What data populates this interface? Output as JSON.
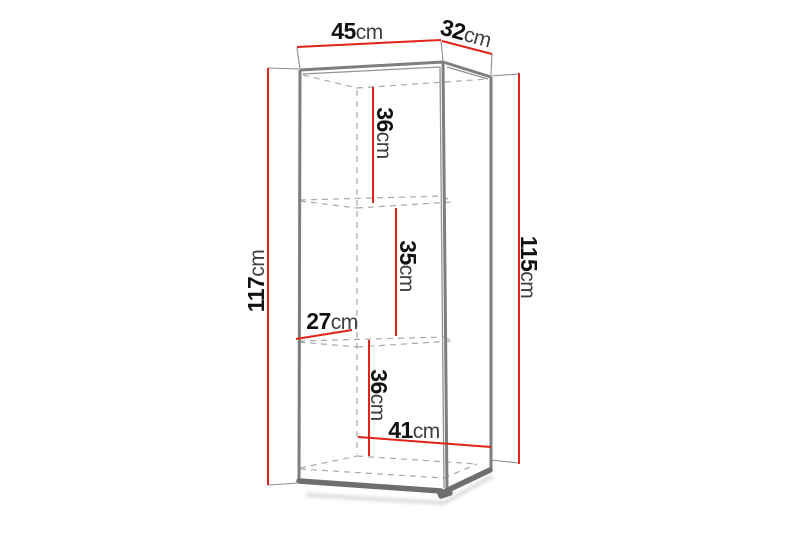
{
  "diagram": {
    "type": "furniture-dimension-drawing",
    "subject": "tall wall cabinet with two shelves, perspective view",
    "unit": "cm",
    "colors": {
      "dimension_red": "#e2231a",
      "cabinet_outline_gray": "#7e7e7e",
      "hidden_edge_dashed_gray": "#a8a8a8",
      "label_text": "#111111",
      "background": "#ffffff"
    },
    "dimensions": {
      "top_width": {
        "value": "45",
        "unit": "cm"
      },
      "top_depth": {
        "value": "32",
        "unit": "cm"
      },
      "left_height": {
        "value": "117",
        "unit": "cm"
      },
      "right_height": {
        "value": "115",
        "unit": "cm"
      },
      "upper_compartment": {
        "value": "36",
        "unit": "cm"
      },
      "middle_compartment": {
        "value": "35",
        "unit": "cm"
      },
      "shelf_depth": {
        "value": "27",
        "unit": "cm"
      },
      "lower_compartment": {
        "value": "36",
        "unit": "cm"
      },
      "interior_width": {
        "value": "41",
        "unit": "cm"
      }
    }
  }
}
